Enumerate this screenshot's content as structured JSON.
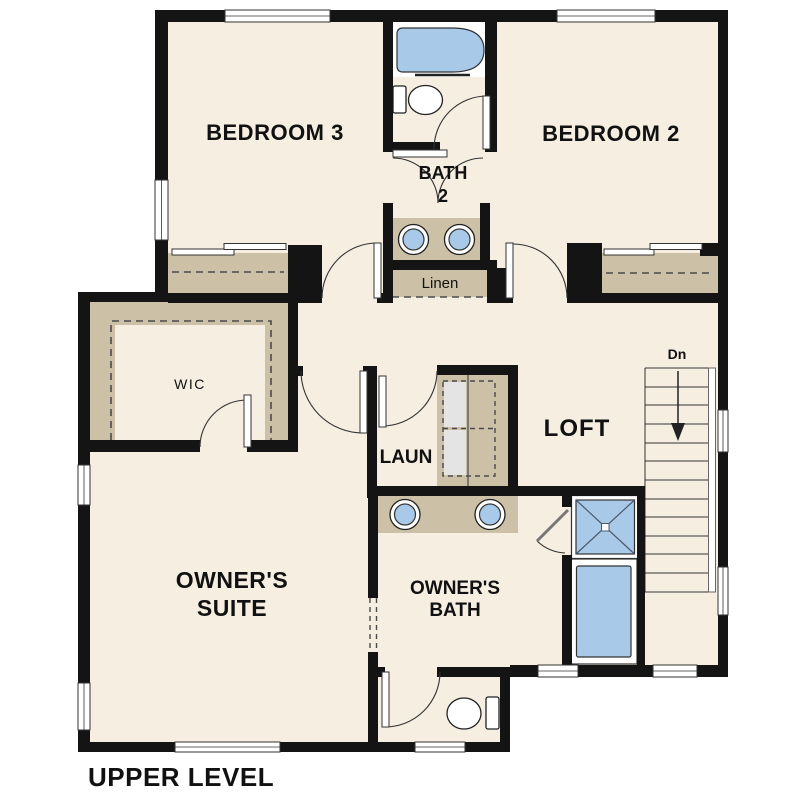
{
  "floor_plan": {
    "level_title": "UPPER LEVEL",
    "labels": {
      "bedroom3": "BEDROOM 3",
      "bedroom2": "BEDROOM 2",
      "bath2_l1": "BATH",
      "bath2_l2": "2",
      "linen": "Linen",
      "wic": "WIC",
      "laundry": "LAUN",
      "loft": "LOFT",
      "owners_suite_l1": "OWNER'S",
      "owners_suite_l2": "SUITE",
      "owners_bath_l1": "OWNER'S",
      "owners_bath_l2": "BATH",
      "stairs_down": "Dn"
    },
    "colors": {
      "background": "#ffffff",
      "floor": "#f5eee1",
      "wall": "#141414",
      "casework": "#ccc0a7",
      "fixture_blue": "#a9c9e9",
      "appliance_gray": "#e4e4e4",
      "text": "#111111"
    },
    "fixtures": [
      "bathtub",
      "toilet",
      "double-vanity-sinks",
      "linen-closet",
      "washer-dryer",
      "shower",
      "soaking-tub",
      "water-closet",
      "staircase-down"
    ]
  }
}
